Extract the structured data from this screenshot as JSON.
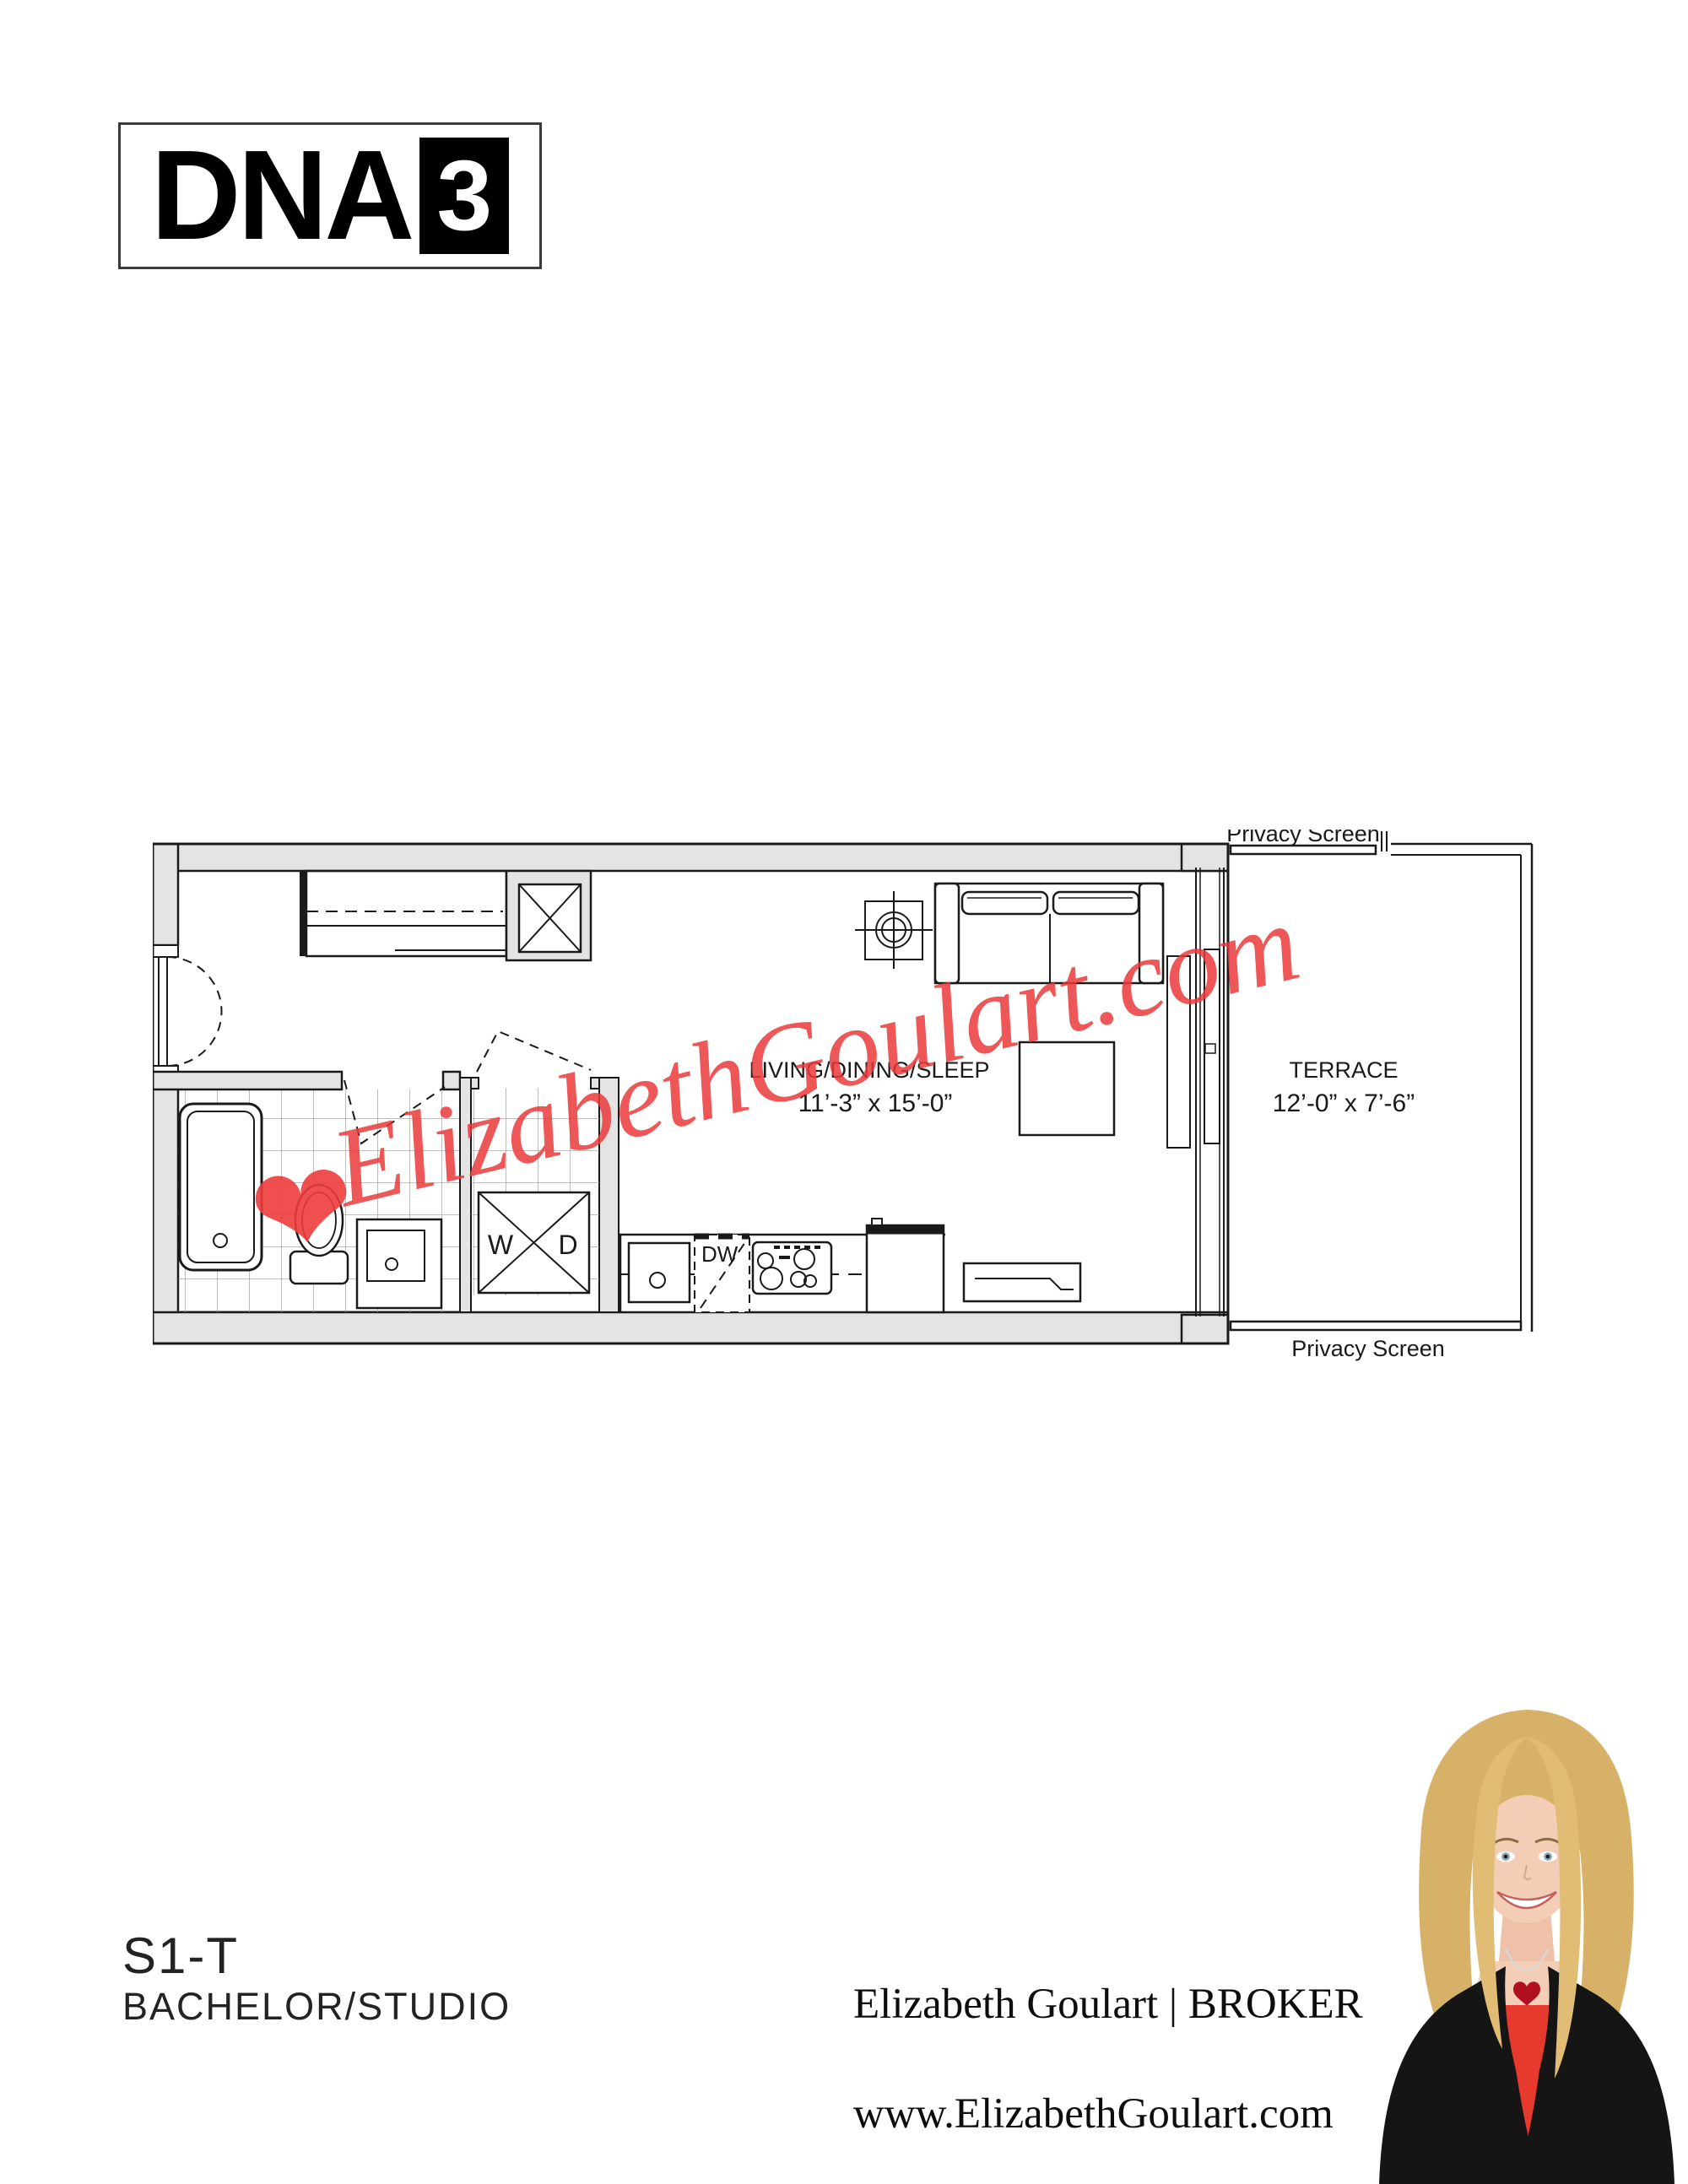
{
  "logo": {
    "brand": "DNA",
    "number": "3"
  },
  "floor_plan": {
    "labels": {
      "privacy_screen_top": "Privacy Screen",
      "privacy_screen_bottom": "Privacy Screen",
      "terrace_name": "TERRACE",
      "terrace_dims": "12’-0” x 7’-6”",
      "living_name": "LIVING/DINING/SLEEP",
      "living_dims": "11’-3” x 15’-0”",
      "washer": "W",
      "dryer": "D",
      "dishwasher": "DW"
    },
    "colors": {
      "wall_fill": "#e4e4e4",
      "line": "#1a1a1a",
      "tile_line": "#9c9c9c"
    }
  },
  "watermark": {
    "text": "ElizabethGoulart.com",
    "heart": "❤",
    "color": "#eb3a3a"
  },
  "unit": {
    "code": "S1-T",
    "type": "BACHELOR/STUDIO"
  },
  "broker": {
    "line": "Elizabeth Goulart | BROKER",
    "website": "www.ElizabethGoulart.com"
  }
}
